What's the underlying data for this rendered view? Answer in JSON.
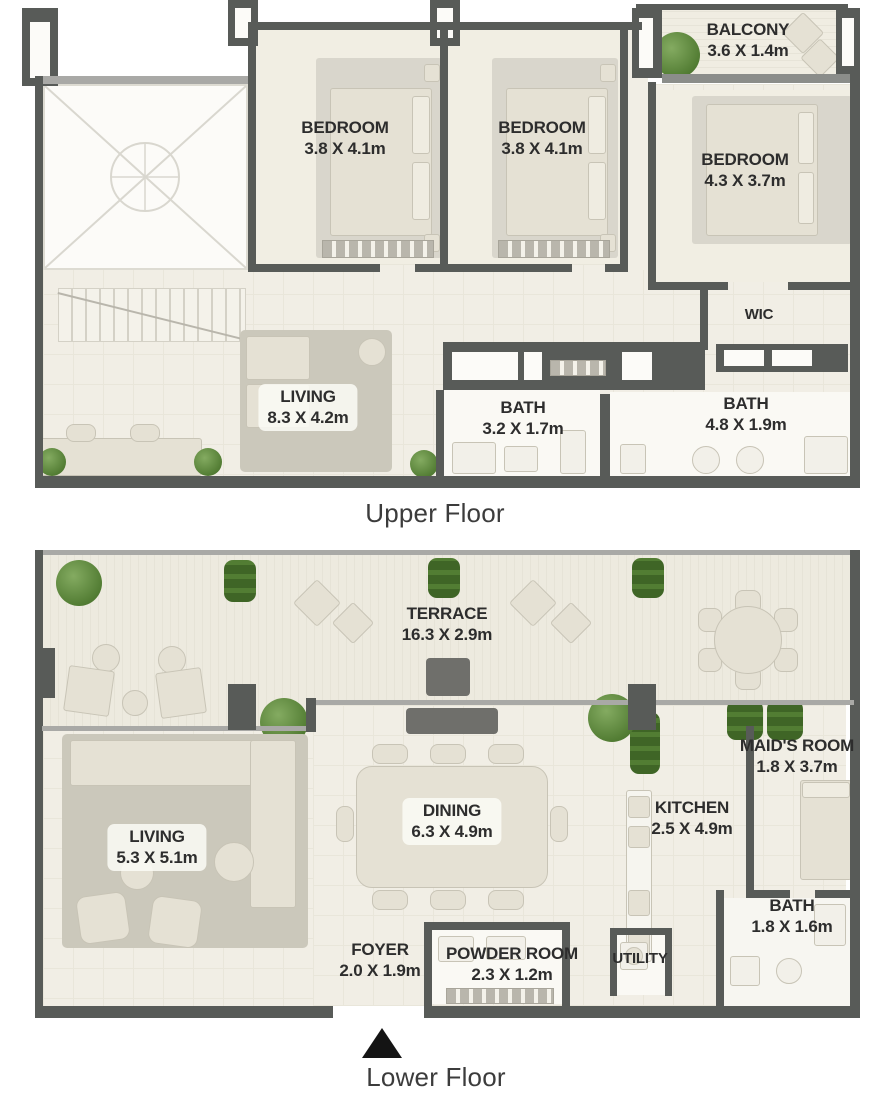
{
  "upper_floor": {
    "caption": "Upper Floor",
    "rooms": {
      "balcony": {
        "name": "BALCONY",
        "dims": "3.6 X 1.4m"
      },
      "bedroom_1": {
        "name": "BEDROOM",
        "dims": "3.8 X 4.1m"
      },
      "bedroom_2": {
        "name": "BEDROOM",
        "dims": "3.8 X 4.1m"
      },
      "bedroom_3": {
        "name": "BEDROOM",
        "dims": "4.3 X 3.7m"
      },
      "wic": {
        "name": "WIC"
      },
      "living": {
        "name": "LIVING",
        "dims": "8.3 X 4.2m"
      },
      "bath_1": {
        "name": "BATH",
        "dims": "3.2 X 1.7m"
      },
      "bath_2": {
        "name": "BATH",
        "dims": "4.8 X 1.9m"
      }
    }
  },
  "lower_floor": {
    "caption": "Lower Floor",
    "rooms": {
      "terrace": {
        "name": "TERRACE",
        "dims": "16.3 X 2.9m"
      },
      "living": {
        "name": "LIVING",
        "dims": "5.3 X 5.1m"
      },
      "dining": {
        "name": "DINING",
        "dims": "6.3 X 4.9m"
      },
      "maids_room": {
        "name": "MAID'S ROOM",
        "dims": "1.8 X 3.7m"
      },
      "kitchen": {
        "name": "KITCHEN",
        "dims": "2.5 X 4.9m"
      },
      "bath": {
        "name": "BATH",
        "dims": "1.8 X 1.6m"
      },
      "foyer": {
        "name": "FOYER",
        "dims": "2.0 X 1.9m"
      },
      "powder_room": {
        "name": "POWDER ROOM",
        "dims": "2.3 X 1.2m"
      },
      "utility": {
        "name": "UTILITY"
      }
    }
  },
  "colors": {
    "wall": "#585b58",
    "floor": "#f1eee5",
    "terrace": "#edeadf",
    "furniture": "#e5e1d4",
    "rug": "#cbc8bb",
    "plant_green": "#537d34",
    "text": "#2d2d2d"
  }
}
